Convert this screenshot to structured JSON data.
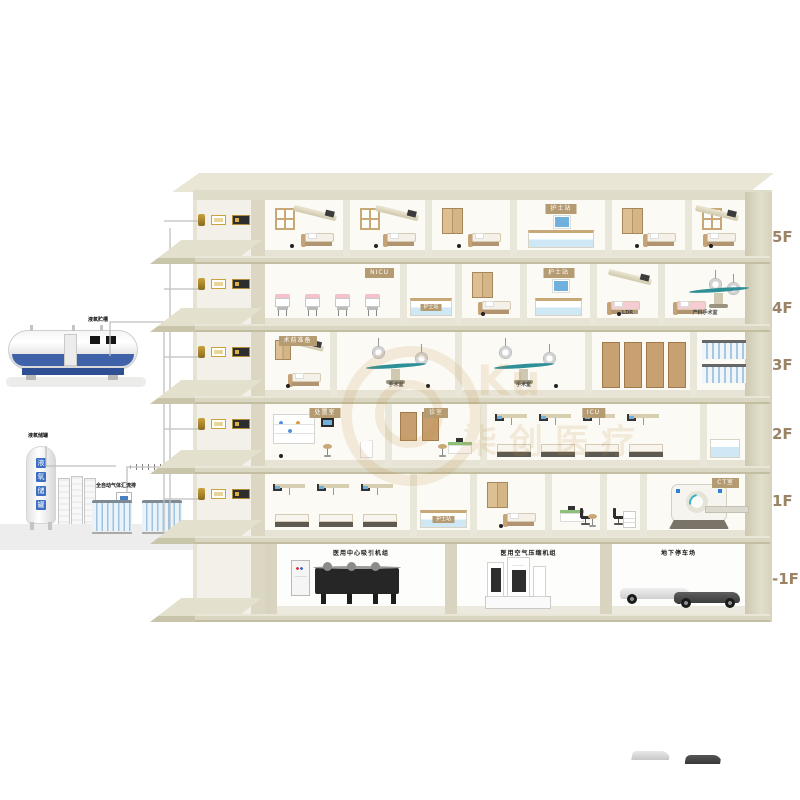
{
  "diagram_title": "医院医用气体系统楼层示意图",
  "watermark": {
    "latin": "Ku",
    "cn": "柒创医疗"
  },
  "colors": {
    "slab": "#d9d6c2",
    "sign_brown": "#b59b72",
    "tank_blue": "#3f62a8",
    "teal": "#2e8f96",
    "label_tan": "#9b8465"
  },
  "supply_station": {
    "lox_tank_label": "液氧贮槽",
    "backup_tank_label": "液氧储罐",
    "backup_tank_chars": "液氧储罐",
    "manifold_label": "全自动气体汇流排"
  },
  "floor_labels": [
    "5F",
    "4F",
    "3F",
    "2F",
    "1F",
    "-1F"
  ],
  "floors": [
    {
      "id": "5F",
      "label": "5F",
      "rooms": [
        {
          "key": "ward-501",
          "kit": "warda",
          "x": 265,
          "w": 78
        },
        {
          "key": "ward-502",
          "kit": "warda",
          "x": 343,
          "w": 82
        },
        {
          "key": "ward-503",
          "kit": "wardb",
          "x": 425,
          "w": 85
        },
        {
          "key": "nurse-station-5f",
          "kit": "nurse",
          "x": 510,
          "w": 95,
          "sign": "护士站"
        },
        {
          "key": "ward-504",
          "kit": "wardb",
          "x": 605,
          "w": 80
        },
        {
          "key": "ward-505",
          "kit": "warda",
          "x": 685,
          "w": 60
        }
      ]
    },
    {
      "id": "4F",
      "label": "4F",
      "rooms": [
        {
          "key": "nicu-ward",
          "kit": "nicu",
          "x": 265,
          "w": 135,
          "sign": "NICU",
          "signpos": "right"
        },
        {
          "key": "reception-counter-4f",
          "kit": "counter",
          "x": 400,
          "w": 55,
          "front": "护士站"
        },
        {
          "key": "ward-401",
          "kit": "wardb",
          "x": 455,
          "w": 65
        },
        {
          "key": "nurse-station-4f",
          "kit": "nurse",
          "x": 520,
          "w": 70,
          "sign": "护士站"
        },
        {
          "key": "ldr-room",
          "kit": "ldr",
          "x": 590,
          "w": 68,
          "tag": "LDR"
        },
        {
          "key": "obstetric-operating-room",
          "kit": "delivery",
          "x": 658,
          "w": 87,
          "tag": "产科手术室"
        }
      ]
    },
    {
      "id": "3F",
      "label": "3F",
      "rooms": [
        {
          "key": "pre-op-room",
          "kit": "prep",
          "x": 265,
          "w": 65,
          "sign": "术前准备"
        },
        {
          "key": "operating-room-1",
          "kit": "or",
          "x": 330,
          "w": 125,
          "tag": "手术室"
        },
        {
          "key": "operating-room-2",
          "kit": "or",
          "x": 455,
          "w": 130,
          "tag": "手术室"
        },
        {
          "key": "instrument-storage",
          "kit": "cabinets",
          "x": 585,
          "w": 105
        },
        {
          "key": "gas-cylinder-room",
          "kit": "cylrack",
          "x": 690,
          "w": 55
        }
      ]
    },
    {
      "id": "2F",
      "label": "2F",
      "rooms": [
        {
          "key": "treatment-room",
          "kit": "shelves",
          "x": 265,
          "w": 120,
          "sign": "处置室"
        },
        {
          "key": "consulting-room",
          "kit": "consult",
          "x": 385,
          "w": 95,
          "sign": "诊室"
        },
        {
          "key": "icu-ward",
          "kit": "icuward",
          "x": 480,
          "w": 220,
          "sign": "ICU"
        },
        {
          "key": "icu-counter",
          "kit": "icucounter",
          "x": 700,
          "w": 45
        }
      ]
    },
    {
      "id": "1F",
      "label": "1F",
      "rooms": [
        {
          "key": "inpatient-ward-1f",
          "kit": "icuward",
          "x": 265,
          "w": 145
        },
        {
          "key": "reception-counter-1f",
          "kit": "counter",
          "x": 410,
          "w": 60,
          "front": "护士站"
        },
        {
          "key": "ward-101",
          "kit": "wardb",
          "x": 470,
          "w": 75
        },
        {
          "key": "doctor-office",
          "kit": "office",
          "x": 545,
          "w": 55
        },
        {
          "key": "ct-control-room",
          "kit": "ctrlroom",
          "x": 600,
          "w": 40
        },
        {
          "key": "ct-room",
          "kit": "ct",
          "x": 640,
          "w": 105,
          "sign": "CT室",
          "signpos": "right"
        }
      ]
    },
    {
      "id": "-1F",
      "label": "-1F",
      "rooms": [
        {
          "key": "vacuum-pump-station",
          "kit": "machdark",
          "x": 265,
          "w": 180,
          "toplabel": "医用中心吸引机组"
        },
        {
          "key": "air-compressor-station",
          "kit": "machwhite",
          "x": 445,
          "w": 155,
          "toplabel": "医用空气压缩机组"
        },
        {
          "key": "underground-parking",
          "kit": "parking",
          "x": 600,
          "w": 145,
          "toplabel": "地下停车场"
        }
      ]
    }
  ]
}
